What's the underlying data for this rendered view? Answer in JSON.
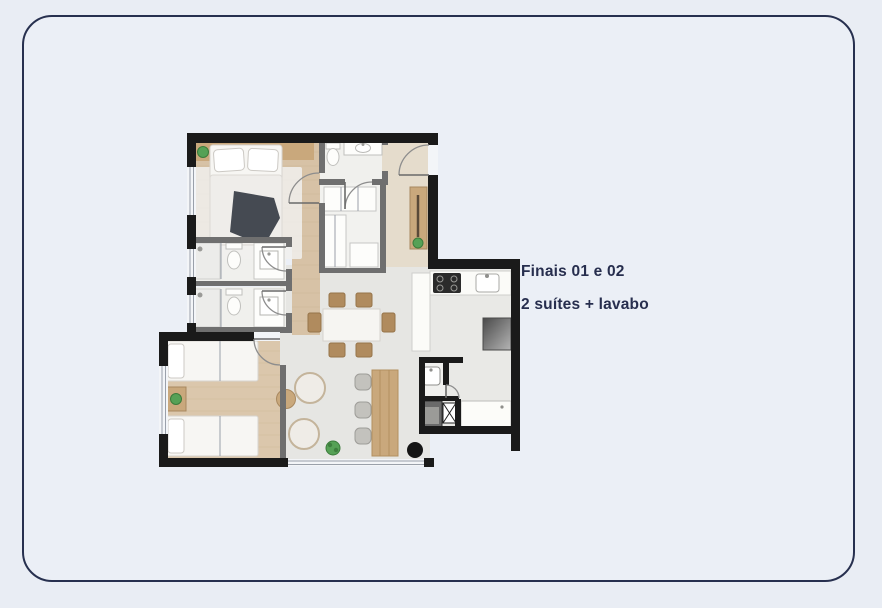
{
  "page": {
    "background": "#e9edf4"
  },
  "card": {
    "border_color": "#27304f",
    "background": "#ebeff6",
    "corner_radius_px": 30
  },
  "caption": {
    "line1": "Finais 01 e 02",
    "line2": "2 suítes + lavabo",
    "text_color": "#272e4e"
  },
  "floor_plan": {
    "type": "apartment-floorplan-top-view",
    "colors": {
      "wall": "#1a1a1a",
      "interior_wall": "#6f6f6f",
      "wood_floor": "#d7c2a6",
      "wood_floor_suite2": "#dbc7ac",
      "hall_floor": "#e5dccc",
      "tile_floor": "#e6e6e3",
      "bath_floor": "#f0f0ed",
      "furniture_wood": "#c9a87c",
      "chair_wood": "#b08b5e",
      "plant_green": "#56a156",
      "textile_dark": "#454a52",
      "window_glass": "#f3f5f8",
      "appliance_dark": "#2b2b2b"
    },
    "rooms": [
      {
        "name": "suite-1-bedroom"
      },
      {
        "name": "suite-1-bathroom"
      },
      {
        "name": "suite-2-bathroom"
      },
      {
        "name": "social-bathroom"
      },
      {
        "name": "closet"
      },
      {
        "name": "entry-hall"
      },
      {
        "name": "living-dining-room"
      },
      {
        "name": "kitchen"
      },
      {
        "name": "lavabo"
      },
      {
        "name": "service-area"
      },
      {
        "name": "suite-2-bedroom"
      }
    ],
    "furniture": [
      {
        "name": "double-bed",
        "count": 1
      },
      {
        "name": "single-bed",
        "count": 2
      },
      {
        "name": "dining-table",
        "count": 1
      },
      {
        "name": "dining-chair",
        "count": 6
      },
      {
        "name": "armchair",
        "count": 2
      },
      {
        "name": "round-side-table",
        "count": 1
      },
      {
        "name": "bench-counter-with-stools",
        "count": 1
      },
      {
        "name": "sideboard",
        "count": 1
      },
      {
        "name": "cooktop",
        "count": 1
      },
      {
        "name": "kitchen-sink",
        "count": 1
      },
      {
        "name": "fridge",
        "count": 1
      },
      {
        "name": "washing-machine",
        "count": 1
      },
      {
        "name": "laundry-counter",
        "count": 1
      },
      {
        "name": "toilet",
        "count": 3
      },
      {
        "name": "vanity-sink",
        "count": 4
      },
      {
        "name": "shower",
        "count": 2
      },
      {
        "name": "plant",
        "count": 4
      }
    ]
  }
}
